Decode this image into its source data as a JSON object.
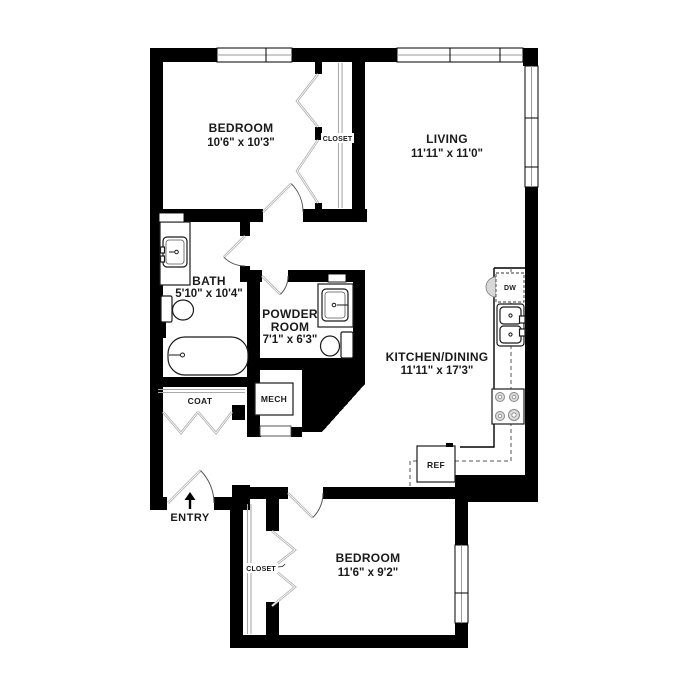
{
  "rooms": {
    "bedroom1": {
      "name": "BEDROOM",
      "dims": "10'6\" x 10'3\""
    },
    "living": {
      "name": "LIVING",
      "dims": "11'11\" x 11'0\""
    },
    "bath": {
      "name": "BATH",
      "dims": "5'10\" x 10'4\""
    },
    "powder_room": {
      "name_line1": "POWDER",
      "name_line2": "ROOM",
      "dims": "7'1\" x 6'3\""
    },
    "kitchen_dining": {
      "name": "KITCHEN/DINING",
      "dims": "11'11\" x 17'3\""
    },
    "bedroom2": {
      "name": "BEDROOM",
      "dims": "11'6\" x 9'2\""
    }
  },
  "labels": {
    "closet_upper": "CLOSET",
    "closet_lower": "CLOSET",
    "coat": "COAT",
    "mech": "MECH",
    "entry": "ENTRY",
    "dishwasher": "DW",
    "refrigerator": "REF"
  },
  "colors": {
    "wall": "#000000",
    "background": "#ffffff",
    "door_leaf": "#a8a8a8",
    "appliance_shade": "#d8d8d8"
  }
}
